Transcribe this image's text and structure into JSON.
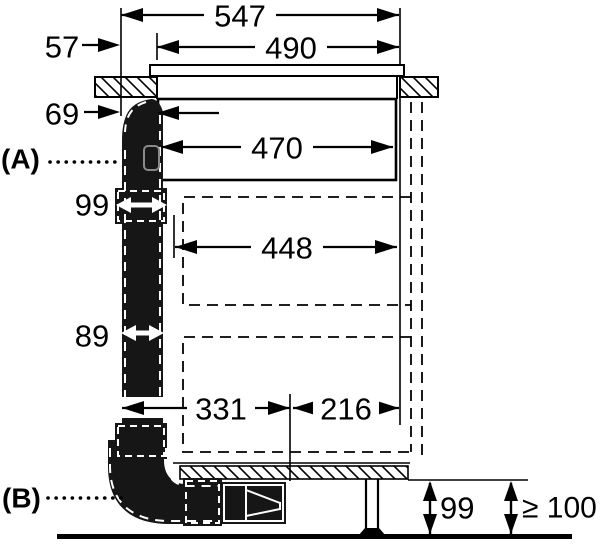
{
  "labels": {
    "section_a": "(A)",
    "section_b": "(B)"
  },
  "dims": {
    "total_width": "547",
    "top_width": "490",
    "left_inset": "57",
    "duct_top_inset": "69",
    "appliance_body_width": "470",
    "duct_coupling_width": "99",
    "inner_clearance_width": "448",
    "duct_width": "89",
    "bottom_left_span": "331",
    "bottom_right_span": "216",
    "plinth_height": "99",
    "min_floor_clearance": "≥ 100"
  },
  "colors": {
    "line": "#000000",
    "duct_fill": "#161616",
    "background": "#ffffff"
  }
}
